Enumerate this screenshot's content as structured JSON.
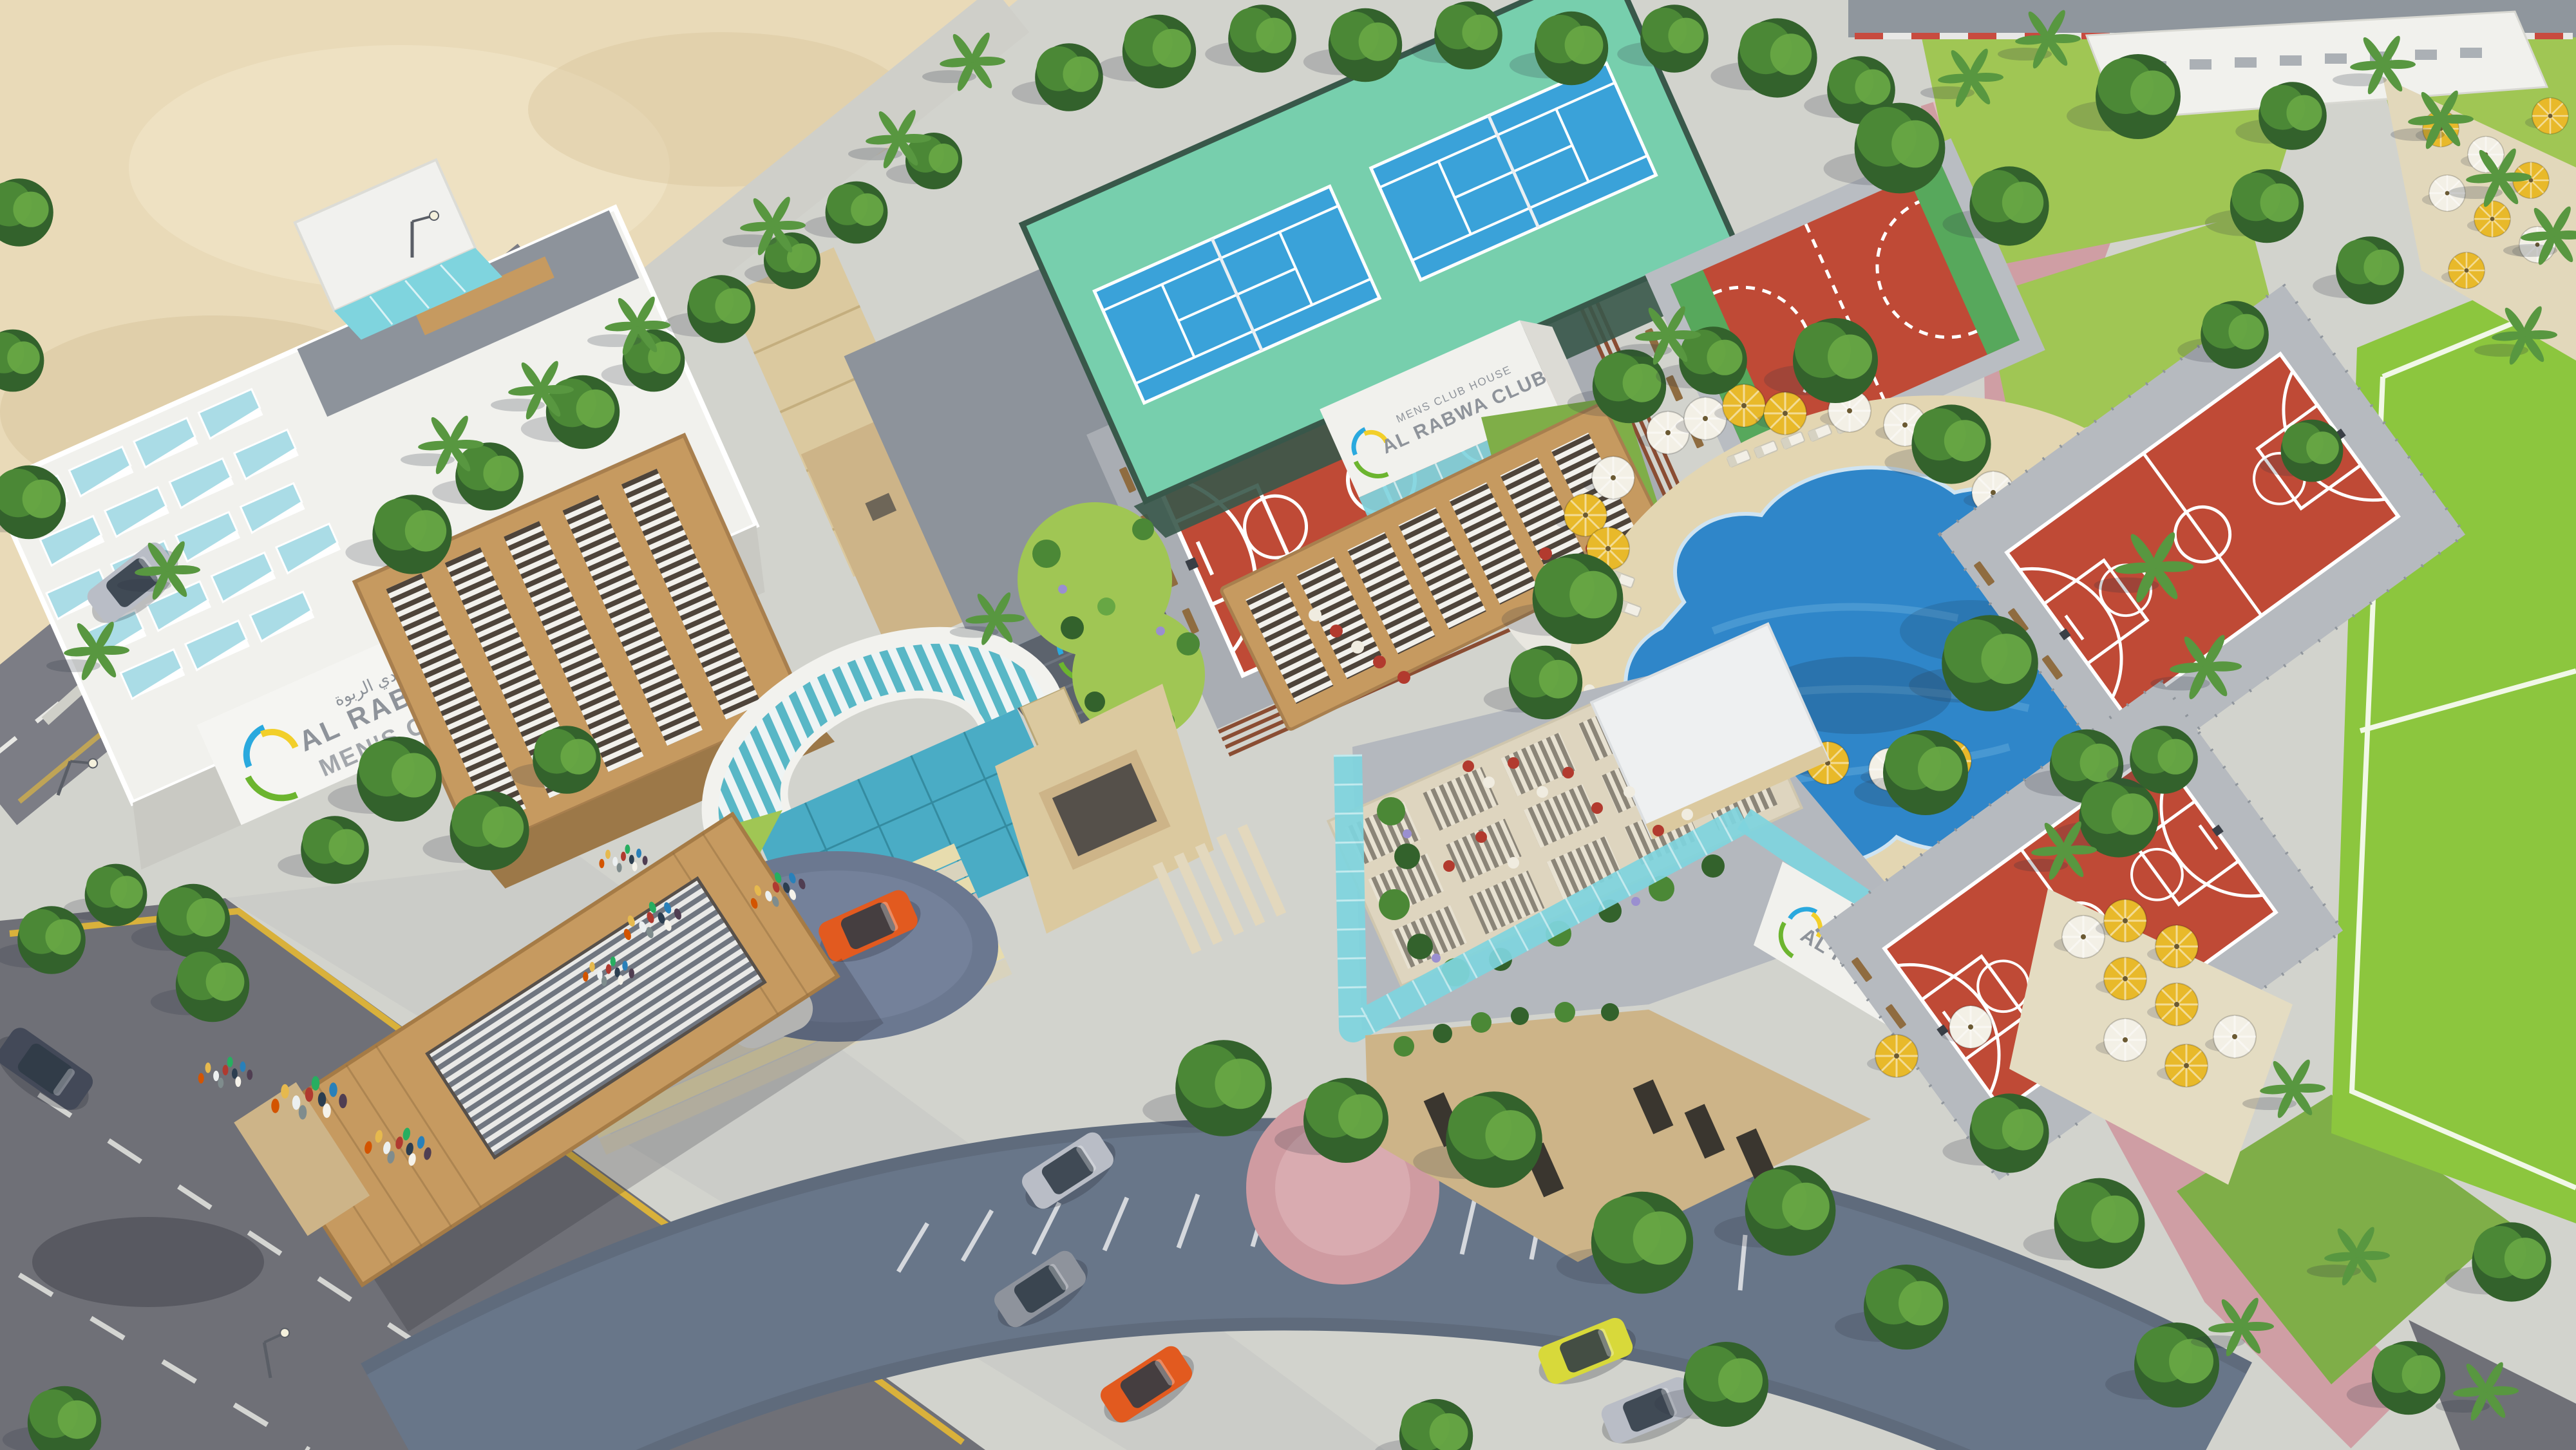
{
  "meta": {
    "scene_type": "aerial-architectural-3d-rendering",
    "project_name": "Al Rabwa Club",
    "description": "Bird's-eye 3D render of the Al Rabwa men's club sports complex with pool, courts, gardens and entrance gates"
  },
  "signage": {
    "main_building": {
      "arabic": "نادي الربوة",
      "brand": "AL RABWA",
      "sub": "MEN'S CLUB"
    },
    "rooftop_wall_sign": {
      "small": "MENS CLUB HOUSE",
      "main": "AL RABWA CLUB"
    },
    "restaurant_fascia": {
      "small": "MEN'S CLUB HOUSE",
      "main": "AL RABWA CLUB"
    },
    "court_ground_paint": "AL RABWA C",
    "gray_wall_monogram": "R"
  },
  "scene_objects": {
    "labels": [
      "desert sand lot",
      "perimeter road",
      "boulevard with lane markings",
      "cobbled service road with parking",
      "white clubhouse with rooftop skylights",
      "wooden louvered annex",
      "entrance arch with curved canopy",
      "wooden entrance gate canopy",
      "rooftop basketball court",
      "tennis courts",
      "handball court",
      "two outdoor basketball courts",
      "free-form swimming pool",
      "pool umbrellas and loungers",
      "cafe pergolas",
      "glass restaurant building with roof terrace",
      "circular lawn islands",
      "park lawns and palm trees",
      "soccer field",
      "umbrella terraces",
      "pedestrian crowds",
      "parked cars"
    ]
  },
  "palette": {
    "sand": "#e9dab8",
    "sand_light": "#f2e7ca",
    "paving": "#d2d3cd",
    "paving_warm": "#e3d6b2",
    "plaza": "#dddfd9",
    "asphalt": "#7c7d85",
    "asphalt_dark": "#6f7077",
    "cobble": "#5f6b7c",
    "cobble_light": "#8194ab",
    "pink_path": "#cf9ba1",
    "pink_light": "#e3bcc0",
    "lawn": "#a0c654",
    "lawn_dark": "#7fae48",
    "field_green": "#8cc63e",
    "tree_dark": "#33622c",
    "tree_mid": "#4b8836",
    "tree_light": "#67a744",
    "palm_green": "#589740",
    "trunk": "#7a5a36",
    "pool_blue": "#2f86c9",
    "pool_ripple": "#6fb3e2",
    "court_red": "#bf4a36",
    "court_line": "#ffffff",
    "tennis_blue": "#3aa2d9",
    "tennis_apron": "#77cfad",
    "fence_green": "#39584a",
    "wood": "#c69a60",
    "wood_dark": "#8f6c40",
    "glass_teal": "#7fd4de",
    "glass_deep": "#3fa9c4",
    "skylight": "#aadce6",
    "white_bldg": "#f1f1ed",
    "stone_beige": "#dbc99f",
    "stone_tan": "#cdb488",
    "gray_wall": "#8d939b",
    "gray_dark": "#5c636d",
    "umbrella_yellow": "#e8b92a",
    "umbrella_white": "#f3f0e6",
    "logo_blue": "#2aa9de",
    "logo_green": "#6cb52f",
    "logo_yellow": "#f2cf2a",
    "car_orange": "#e25a1f",
    "car_yellow": "#d8d93a",
    "car_silver": "#b9bdc6",
    "car_dark": "#434958",
    "text_gray": "#8e939a"
  }
}
